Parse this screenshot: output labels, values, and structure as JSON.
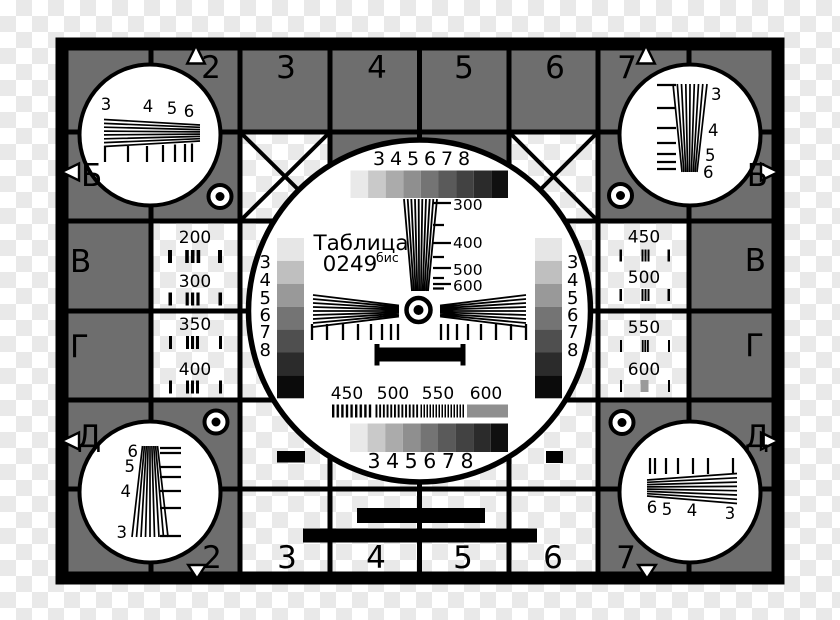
{
  "card_name": "Таблица 0249 бис",
  "colors": {
    "cell_gray": "#6e6e6e",
    "checker": "#e9e9e9",
    "ink": "#000000",
    "burst_gray": "#8f8f8f",
    "bar_gray": "#9a9a9a",
    "white": "#ffffff"
  },
  "header_numbers": [
    "2",
    "3",
    "4",
    "5",
    "6",
    "7"
  ],
  "footer_numbers": [
    "2",
    "3",
    "4",
    "5",
    "6",
    "7"
  ],
  "row_letters_left": [
    "Б",
    "В",
    "Г",
    "Д"
  ],
  "row_letters_right": [
    "Б",
    "В",
    "Г",
    "Д"
  ],
  "center": {
    "title": "Таблица",
    "code": "0249",
    "code_suffix": "бис",
    "gray_steps": [
      "3",
      "4",
      "5",
      "6",
      "7",
      "8"
    ],
    "freq_ticks": [
      "300",
      "400",
      "500",
      "600"
    ],
    "burst_labels": [
      "450",
      "500",
      "550",
      "600"
    ],
    "shades9": [
      "#e9e9e9",
      "#c9c9c9",
      "#ababab",
      "#8f8f8f",
      "#747474",
      "#5a5a5a",
      "#424242",
      "#2b2b2b",
      "#101010"
    ],
    "shades7": [
      "#e6e6e6",
      "#bfbfbf",
      "#999999",
      "#747474",
      "#4f4f4f",
      "#2b2b2b",
      "#0b0b0b"
    ]
  },
  "resolution_labels_left": [
    "200",
    "300",
    "350",
    "400"
  ],
  "resolution_labels_right": [
    "450",
    "500",
    "550",
    "600"
  ],
  "corner_wedge_labels": {
    "tl": [
      "3",
      "4",
      "5",
      "6"
    ],
    "tr": [
      "3",
      "4",
      "5",
      "6"
    ],
    "bl": [
      "6",
      "5",
      "4",
      "3"
    ],
    "br": [
      "6",
      "5",
      "4",
      "3"
    ]
  }
}
